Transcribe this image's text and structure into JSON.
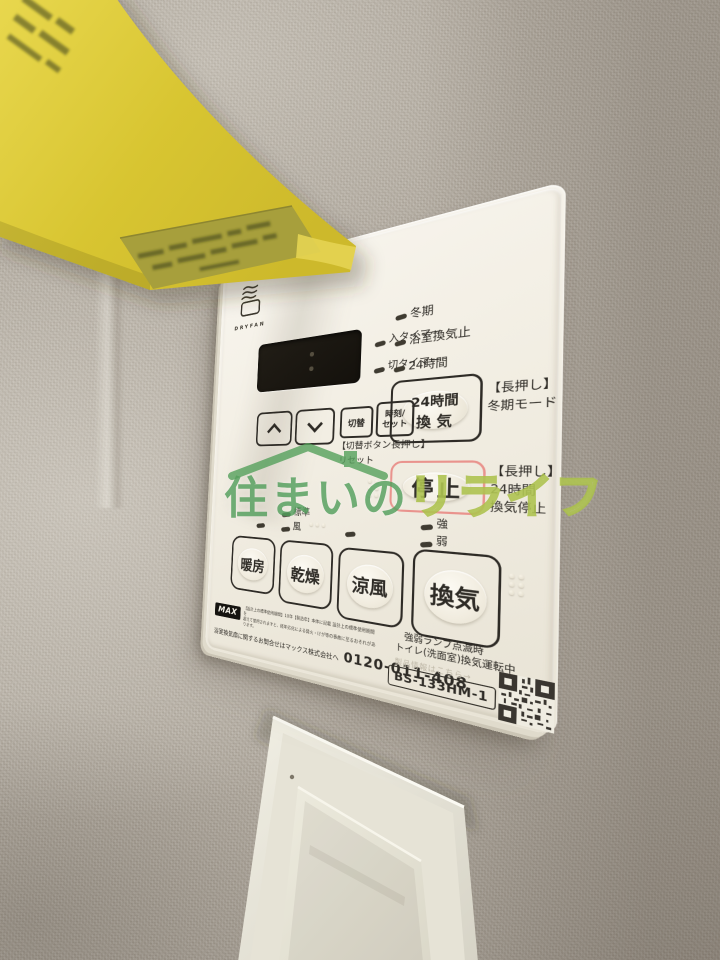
{
  "watermark": {
    "text_solid": "住まいの",
    "text_outline": "リライフ",
    "green_solid": "#4a9a55",
    "green_outline": "#a9c046"
  },
  "scene": {
    "tape_color": "#d9c531",
    "wall_color": "#b3aca1",
    "objects": [
      "yellow-masking-tape",
      "ventilation-control-panel",
      "light-rocker-switch"
    ]
  },
  "panel": {
    "brand": "DRYFAN",
    "model": "BS-133HM-1",
    "ink_color": "#2e2b26",
    "stop_outline_color": "#e9938d",
    "display_colon": ":",
    "timer_leds": [
      {
        "label": "入タイマー"
      },
      {
        "label": "切タイマー"
      }
    ],
    "status_leds": [
      {
        "label": "冬期"
      },
      {
        "label": "浴室換気止"
      },
      {
        "label": "24時間"
      }
    ],
    "vent24_button": {
      "line1": "24時間",
      "line2": "換気"
    },
    "vent24_hint": {
      "line1": "【長押し】",
      "line2": "冬期モード"
    },
    "stop_button": "停止",
    "stop_hint": {
      "line1": "【長押し】",
      "line2": "24時間",
      "line3": "換気停止"
    },
    "switch_button": "切替",
    "clock_button": {
      "line1": "時刻/",
      "line2": "セット"
    },
    "reset_hint": {
      "line1": "【切替ボタン長押し】",
      "line2": "リセット"
    },
    "mode_leds": {
      "dry": [
        {
          "label": "標準"
        },
        {
          "label": "風"
        }
      ],
      "vent": [
        {
          "label": "強"
        },
        {
          "label": "弱"
        }
      ]
    },
    "mode_buttons": [
      {
        "label": "暖房"
      },
      {
        "label": "乾燥"
      },
      {
        "label": "涼風"
      },
      {
        "label": "換気"
      }
    ],
    "footer": {
      "max_logo": "MAX",
      "fine_print_1": "【設計上の標準使用期間】10年【製造年】本体に記載 設計上の標準使用期間を",
      "fine_print_2": "超えて使用されますと、経年劣化による発火・けが等の事故に至るおそれがあります。",
      "contact": "浴室換気扇に関するお問合せはマックス株式会社へ",
      "phone": "0120-011-408",
      "note_line1": "強弱ランプ点滅時",
      "note_line2": "トイレ(洗面室)換気運転中",
      "product_info": "製品情報はこちら→"
    }
  }
}
